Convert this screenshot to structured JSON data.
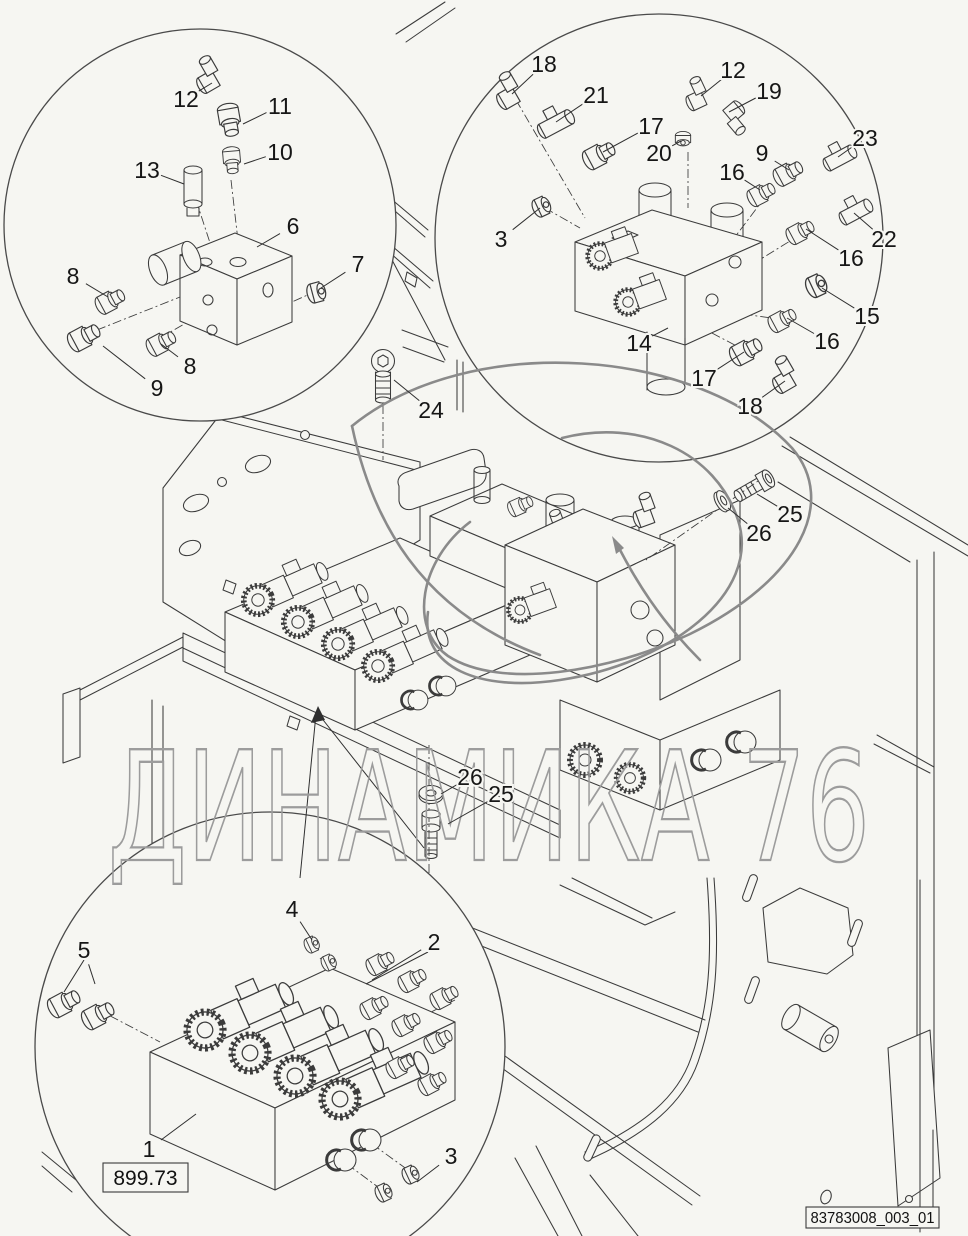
{
  "watermark": {
    "text": "ДИНАМИКА 76"
  },
  "reference_box": {
    "label": "899.73"
  },
  "document_id_box": {
    "label": "83783008_003_01"
  },
  "callouts": [
    {
      "n": "12",
      "x": 186,
      "y": 99,
      "tx": 212,
      "ty": 83
    },
    {
      "n": "11",
      "x": 280,
      "y": 106,
      "tx": 243,
      "ty": 124
    },
    {
      "n": "10",
      "x": 280,
      "y": 152,
      "tx": 244,
      "ty": 164
    },
    {
      "n": "13",
      "x": 147,
      "y": 170,
      "tx": 184,
      "ty": 184
    },
    {
      "n": "6",
      "x": 293,
      "y": 226,
      "tx": 257,
      "ty": 247
    },
    {
      "n": "7",
      "x": 358,
      "y": 264,
      "tx": 321,
      "ty": 288
    },
    {
      "n": "8",
      "x": 73,
      "y": 276,
      "tx": 108,
      "ty": 297
    },
    {
      "n": "8",
      "x": 190,
      "y": 366,
      "tx": 161,
      "ty": 344
    },
    {
      "n": "9",
      "x": 157,
      "y": 388,
      "tx": 103,
      "ty": 346
    },
    {
      "n": "18",
      "x": 544,
      "y": 64,
      "tx": 512,
      "ty": 94
    },
    {
      "n": "21",
      "x": 596,
      "y": 95,
      "tx": 556,
      "ty": 122
    },
    {
      "n": "17",
      "x": 651,
      "y": 126,
      "tx": 603,
      "ty": 152
    },
    {
      "n": "12",
      "x": 733,
      "y": 70,
      "tx": 701,
      "ty": 96
    },
    {
      "n": "19",
      "x": 769,
      "y": 91,
      "tx": 729,
      "ty": 112
    },
    {
      "n": "20",
      "x": 659,
      "y": 153,
      "tx": 681,
      "ty": 141
    },
    {
      "n": "9",
      "x": 762,
      "y": 153,
      "tx": 789,
      "ty": 170
    },
    {
      "n": "23",
      "x": 865,
      "y": 138,
      "tx": 838,
      "ty": 157
    },
    {
      "n": "16",
      "x": 732,
      "y": 172,
      "tx": 760,
      "ty": 190
    },
    {
      "n": "22",
      "x": 884,
      "y": 239,
      "tx": 854,
      "ty": 213
    },
    {
      "n": "3",
      "x": 501,
      "y": 239,
      "tx": 540,
      "ty": 208
    },
    {
      "n": "16",
      "x": 851,
      "y": 258,
      "tx": 806,
      "ty": 229
    },
    {
      "n": "15",
      "x": 867,
      "y": 316,
      "tx": 822,
      "ty": 288
    },
    {
      "n": "16",
      "x": 827,
      "y": 341,
      "tx": 787,
      "ty": 318
    },
    {
      "n": "14",
      "x": 639,
      "y": 343,
      "tx": 668,
      "ty": 328
    },
    {
      "n": "17",
      "x": 704,
      "y": 378,
      "tx": 744,
      "ty": 352
    },
    {
      "n": "18",
      "x": 750,
      "y": 406,
      "tx": 785,
      "ty": 381
    },
    {
      "n": "24",
      "x": 431,
      "y": 410,
      "tx": 394,
      "ty": 380
    },
    {
      "n": "25",
      "x": 790,
      "y": 514,
      "tx": 757,
      "ty": 494
    },
    {
      "n": "26",
      "x": 759,
      "y": 533,
      "tx": 728,
      "ty": 508
    },
    {
      "n": "26",
      "x": 470,
      "y": 777,
      "tx": 441,
      "ty": 794
    },
    {
      "n": "25",
      "x": 501,
      "y": 794,
      "tx": 448,
      "ty": 824
    },
    {
      "n": "5",
      "x": 84,
      "y": 950,
      "tx": 95,
      "ty": 984
    },
    {
      "n": "4",
      "x": 292,
      "y": 909,
      "tx": 312,
      "ty": 940
    },
    {
      "n": "2",
      "x": 434,
      "y": 942,
      "tx": 372,
      "ty": 980
    },
    {
      "n": "1",
      "x": 149,
      "y": 1149,
      "tx": 196,
      "ty": 1114
    },
    {
      "n": "3",
      "x": 451,
      "y": 1156,
      "tx": 417,
      "ty": 1182
    }
  ]
}
